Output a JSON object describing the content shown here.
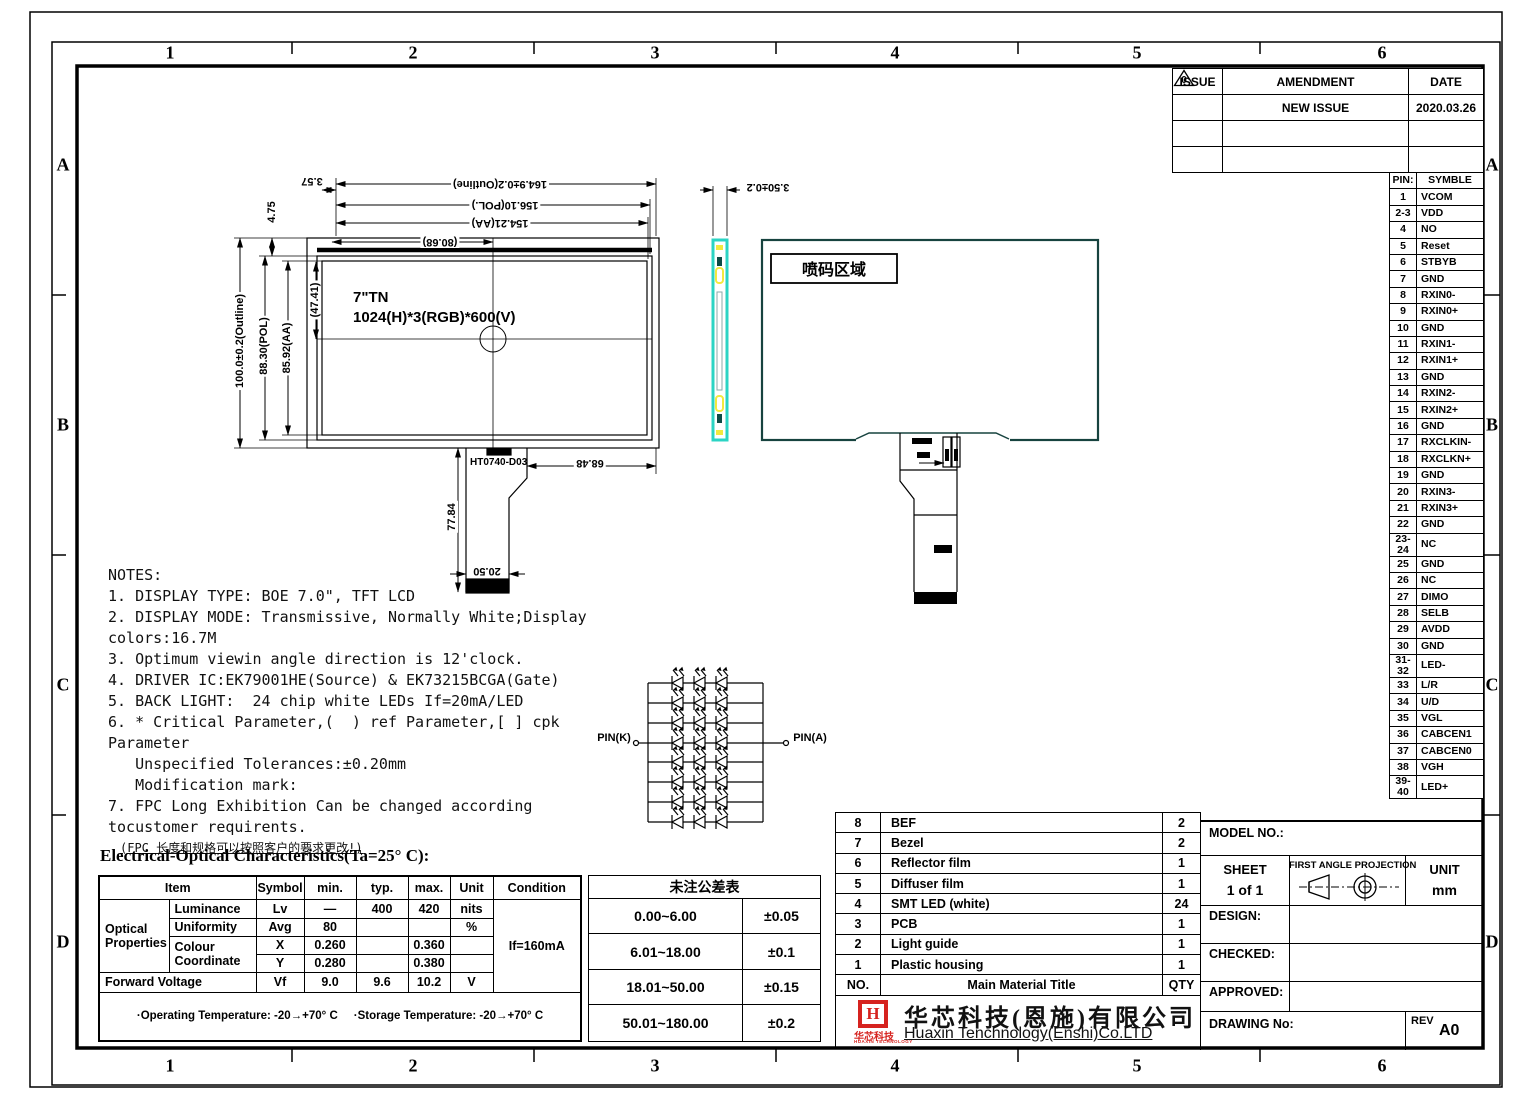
{
  "grid": {
    "cols": [
      "1",
      "2",
      "3",
      "4",
      "5",
      "6"
    ],
    "rows": [
      "A",
      "B",
      "C",
      "D"
    ]
  },
  "issue_table": {
    "headers": [
      "ISSUE",
      "AMENDMENT",
      "DATE"
    ],
    "rows": [
      {
        "issue_mark": "0",
        "amendment": "NEW ISSUE",
        "date": "2020.03.26"
      },
      {
        "issue_mark": "",
        "amendment": "",
        "date": ""
      },
      {
        "issue_mark": "",
        "amendment": "",
        "date": ""
      }
    ]
  },
  "pin_table": {
    "header": {
      "pin": "PIN:",
      "sym": "SYMBLE"
    },
    "rows": [
      {
        "pin": "1",
        "sym": "VCOM"
      },
      {
        "pin": "2-3",
        "sym": "VDD"
      },
      {
        "pin": "4",
        "sym": "NO"
      },
      {
        "pin": "5",
        "sym": "Reset"
      },
      {
        "pin": "6",
        "sym": "STBYB"
      },
      {
        "pin": "7",
        "sym": "GND"
      },
      {
        "pin": "8",
        "sym": "RXIN0-"
      },
      {
        "pin": "9",
        "sym": "RXIN0+"
      },
      {
        "pin": "10",
        "sym": "GND"
      },
      {
        "pin": "11",
        "sym": "RXIN1-"
      },
      {
        "pin": "12",
        "sym": "RXIN1+"
      },
      {
        "pin": "13",
        "sym": "GND"
      },
      {
        "pin": "14",
        "sym": "RXIN2-"
      },
      {
        "pin": "15",
        "sym": "RXIN2+"
      },
      {
        "pin": "16",
        "sym": "GND"
      },
      {
        "pin": "17",
        "sym": "RXCLKIN-"
      },
      {
        "pin": "18",
        "sym": "RXCLKN+"
      },
      {
        "pin": "19",
        "sym": "GND"
      },
      {
        "pin": "20",
        "sym": "RXIN3-"
      },
      {
        "pin": "21",
        "sym": "RXIN3+"
      },
      {
        "pin": "22",
        "sym": "GND"
      },
      {
        "pin": "23-24",
        "sym": "NC"
      },
      {
        "pin": "25",
        "sym": "GND"
      },
      {
        "pin": "26",
        "sym": "NC"
      },
      {
        "pin": "27",
        "sym": "DIMO"
      },
      {
        "pin": "28",
        "sym": "SELB"
      },
      {
        "pin": "29",
        "sym": "AVDD"
      },
      {
        "pin": "30",
        "sym": "GND"
      },
      {
        "pin": "31-32",
        "sym": "LED-"
      },
      {
        "pin": "33",
        "sym": "L/R"
      },
      {
        "pin": "34",
        "sym": "U/D"
      },
      {
        "pin": "35",
        "sym": "VGL"
      },
      {
        "pin": "36",
        "sym": "CABCEN1"
      },
      {
        "pin": "37",
        "sym": "CABCEN0"
      },
      {
        "pin": "38",
        "sym": "VGH"
      },
      {
        "pin": "39-40",
        "sym": "LED+"
      }
    ]
  },
  "front_view": {
    "panel_line1": "7\"TN",
    "panel_line2": "1024(H)*3(RGB)*600(V)",
    "fpc_label": "HT0740-D03",
    "dims": {
      "outline_w": "164.9±0.2(Outline)",
      "pol_w": "156.10(POL.)",
      "aa_w": "154.21(AA)",
      "half_w": "(80.68)",
      "gap_357": "3.57",
      "gap_475": "4.75",
      "outline_h": "100.0±0.2(Outline)",
      "pol_h": "88.30(POL)",
      "aa_h": "85.92(AA)",
      "half_h": "(47.41)",
      "fpc_w": "68.48",
      "fpc_h": "77.84",
      "fpc_conn_w": "20.50"
    }
  },
  "side_view": {
    "thickness_dim": "3.50±0.2"
  },
  "back_view": {
    "coding_area_label": "喷码区域"
  },
  "led_circuit": {
    "pin_k": "PIN(K)",
    "pin_a": "PIN(A)"
  },
  "notes": {
    "lines": [
      "NOTES:",
      "1. DISPLAY TYPE: BOE 7.0\", TFT LCD",
      "2. DISPLAY MODE: Transmissive, Normally White;Display",
      "colors:16.7M",
      "3. Optimum viewin angle direction is 12'clock.",
      "4. DRIVER IC:EK79001HE(Source) & EK73215BCGA(Gate)",
      "5. BACK LIGHT:  24 chip white LEDs If=20mA/LED",
      "6. * Critical Parameter,(  ) ref Parameter,[ ] cpk",
      "Parameter",
      "   Unspecified Tolerances:±0.20mm",
      "   Modification mark:",
      "7. FPC Long Exhibition Can be changed according",
      "tocustomer requirents.",
      "(FPC 长度和规格可以按照客户的要求更改!)"
    ]
  },
  "eo_section": {
    "title": "Electrical-Optical Characteristics(Ta=25° C):",
    "headers": {
      "item": "Item",
      "symbol": "Symbol",
      "min": "min.",
      "typ": "typ.",
      "max": "max.",
      "unit": "Unit",
      "condition": "Condition"
    },
    "group_label_1": "Optical",
    "group_label_2": "Properties",
    "rows": {
      "luminance": {
        "item": "Luminance",
        "symbol": "Lv",
        "min": "—",
        "typ": "400",
        "max": "420",
        "unit": "nits"
      },
      "uniformity": {
        "item": "Uniformity",
        "symbol": "Avg",
        "min": "80",
        "typ": "",
        "max": "",
        "unit": "%"
      },
      "colour_label_1": "Colour",
      "colour_label_2": "Coordinate",
      "colour_x": {
        "symbol": "X",
        "min": "0.260",
        "typ": "",
        "max": "0.360",
        "unit": ""
      },
      "colour_y": {
        "symbol": "Y",
        "min": "0.280",
        "typ": "",
        "max": "0.380",
        "unit": ""
      },
      "forward_voltage": {
        "item": "Forward Voltage",
        "symbol": "Vf",
        "min": "9.0",
        "typ": "9.6",
        "max": "10.2",
        "unit": "V"
      }
    },
    "condition_value": "If=160mA",
    "footer_left": "·Operating Temperature:   -20→+70° C",
    "footer_right": "·Storage Temperature:   -20→+70° C"
  },
  "tolerance_table": {
    "title": "未注公差表",
    "rows": [
      {
        "range": "0.00~6.00",
        "tol": "±0.05"
      },
      {
        "range": "6.01~18.00",
        "tol": "±0.1"
      },
      {
        "range": "18.01~50.00",
        "tol": "±0.15"
      },
      {
        "range": "50.01~180.00",
        "tol": "±0.2"
      }
    ]
  },
  "material_table": {
    "rows": [
      {
        "no": "8",
        "name": "BEF",
        "qty": "2"
      },
      {
        "no": "7",
        "name": "Bezel",
        "qty": "2"
      },
      {
        "no": "6",
        "name": "Reflector film",
        "qty": "1"
      },
      {
        "no": "5",
        "name": "Diffuser film",
        "qty": "1"
      },
      {
        "no": "4",
        "name": "SMT LED (white)",
        "qty": "24"
      },
      {
        "no": "3",
        "name": "PCB",
        "qty": "1"
      },
      {
        "no": "2",
        "name": "Light guide",
        "qty": "1"
      },
      {
        "no": "1",
        "name": "Plastic housing",
        "qty": "1"
      }
    ],
    "footer": {
      "no": "NO.",
      "name": "Main Material Title",
      "qty": "QTY"
    }
  },
  "company": {
    "logo_letter": "H",
    "logo_sub": "华芯科技",
    "logo_sub2": "HUAXIN TECHNOLOGY",
    "name_cn": "华芯科技(恩施)有限公司",
    "name_en": "Huaxin Tenchnology(Enshi)Co.LTD"
  },
  "title_block": {
    "model_no": "MODEL NO.:",
    "sheet_label": "SHEET",
    "sheet_value": "1 of 1",
    "projection_label": "FIRST ANGLE PROJECTION",
    "unit_label": "UNIT",
    "unit_value": "mm",
    "design": "DESIGN:",
    "checked": "CHECKED:",
    "approved": "APPROVED:",
    "drawing_no": "DRAWING No:",
    "rev_label": "REV",
    "rev_value": "A0"
  }
}
